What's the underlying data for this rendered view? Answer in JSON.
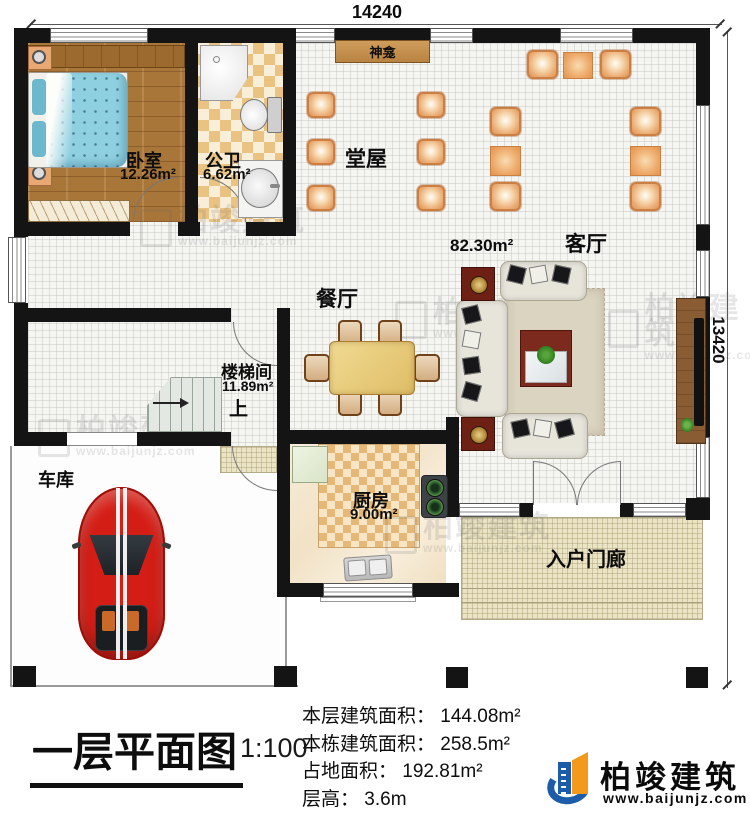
{
  "plan": {
    "dim_top": "14240",
    "dim_right": "13420"
  },
  "rooms": {
    "bedroom": {
      "name": "卧室",
      "area": "12.26m²"
    },
    "bathroom": {
      "name": "公卫",
      "area": "6.62m²"
    },
    "shrine": {
      "name": "神龛"
    },
    "hall": {
      "name": "堂屋"
    },
    "living": {
      "name": "客厅",
      "area": "82.30m²"
    },
    "dining": {
      "name": "餐厅"
    },
    "stairwell": {
      "name": "楼梯间",
      "area": "11.89m²",
      "direction": "上"
    },
    "garage": {
      "name": "车库"
    },
    "kitchen": {
      "name": "厨房",
      "area": "9.00m²"
    },
    "porch": {
      "name": "入户门廊"
    }
  },
  "titleblock": {
    "title": "一层平面图",
    "scale": "1:100",
    "info": [
      "本层建筑面积： 144.08m²",
      "本栋建筑面积： 258.5m²",
      "占地面积： 192.81m²",
      "层高： 3.6m"
    ]
  },
  "brand": {
    "name": "柏竣建筑",
    "website": "www.baijunjz.com"
  },
  "watermark": {
    "name": "柏竣建筑",
    "website": "www.baijunjz.com"
  },
  "colors": {
    "wall": "#141414",
    "chair_orange": "#e09a5e",
    "wood_floor": "#a9763a",
    "car_red": "#d31d15",
    "logo_blue": "#1c5ca8",
    "logo_orange": "#f39a1c"
  }
}
